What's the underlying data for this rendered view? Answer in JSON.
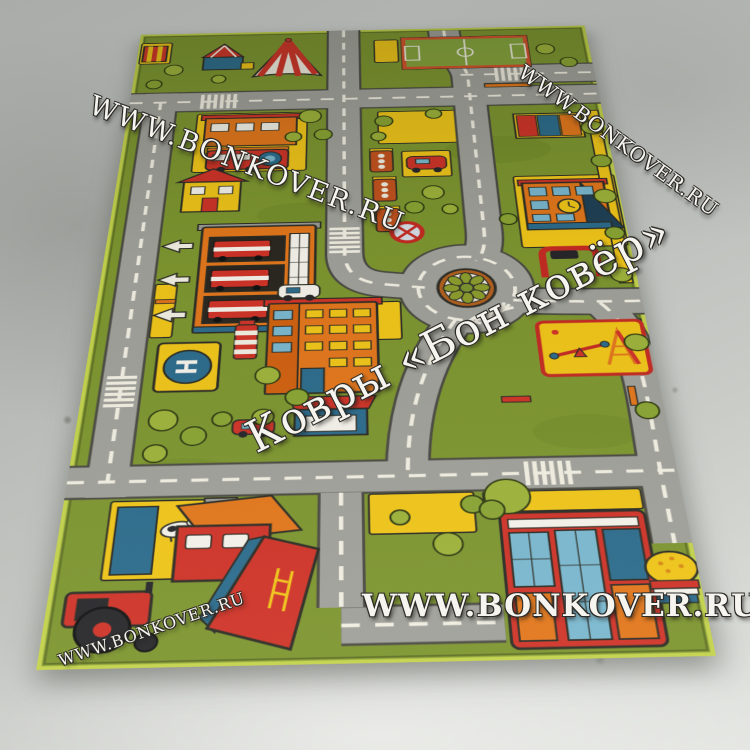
{
  "photo": {
    "subject": "Children's city road play rug photographed on a concrete floor",
    "floor_color": "#c6c8c4"
  },
  "watermarks": {
    "top_left": "WWW.BONKOVER.RU",
    "top_right": "WWW.BONKOVER.RU",
    "center": "Ковры «Бон ковёр»",
    "bottom": "WWW.BONKOVER.RU",
    "bottom_left": "WWW.BONKOVER.RU"
  },
  "rug": {
    "helipad_letter": "H",
    "colors": {
      "grass": "#7d952f",
      "road": "#a0a09b",
      "road_dash": "#f1eee2",
      "plot_yellow": "#f0c518",
      "accent_red": "#cf3227",
      "accent_orange": "#e2761b",
      "accent_teal": "#2b6b8c",
      "edge_binding": "#c3d24b"
    },
    "landmarks": [
      "circus-tent",
      "carousel",
      "striped-kiosk",
      "football-field",
      "train-station",
      "shop-row",
      "traffic-lights",
      "parked-car",
      "road-sign",
      "fire-station",
      "left-arrows",
      "helipad",
      "striped-pump",
      "apartment-building",
      "roundabout-flower",
      "school-with-clock",
      "goal-frame",
      "playground-seesaw-slide",
      "benches",
      "farm-pasture",
      "cows",
      "tractor",
      "barn",
      "big-house",
      "burger-stand",
      "crosswalks",
      "trees-and-bushes"
    ]
  }
}
